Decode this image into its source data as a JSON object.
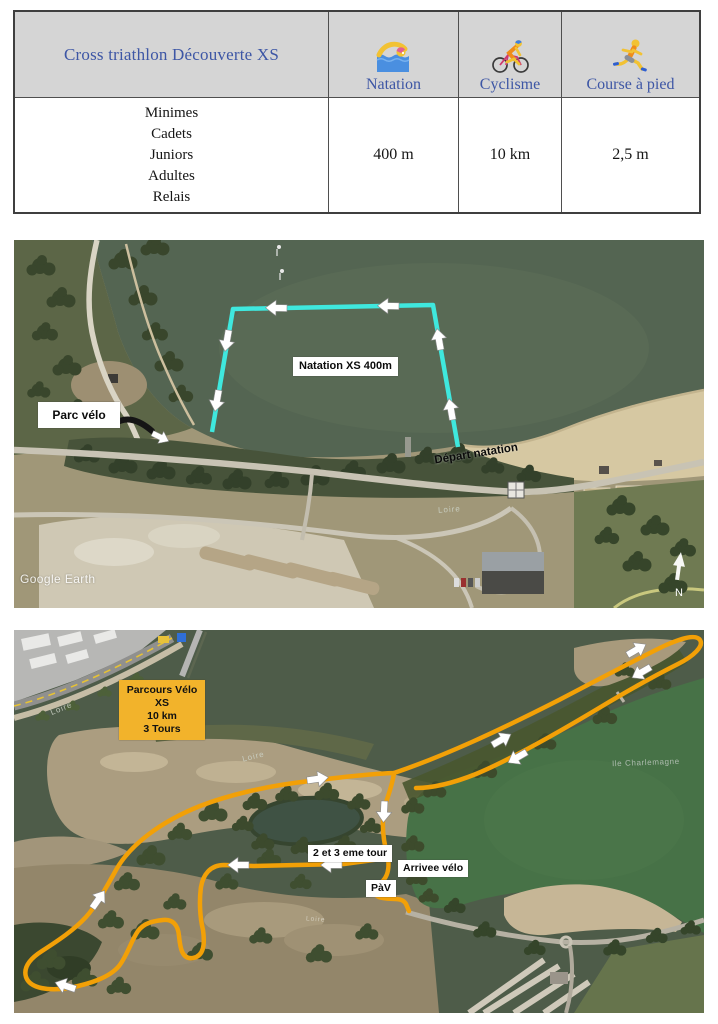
{
  "table": {
    "title": "Cross triathlon Découverte XS",
    "columns": [
      {
        "label": "Natation",
        "icon": "swimmer-icon"
      },
      {
        "label": "Cyclisme",
        "icon": "cyclist-icon"
      },
      {
        "label": "Course à pied",
        "icon": "runner-icon"
      }
    ],
    "categories": [
      "Minimes",
      "Cadets",
      "Juniors",
      "Adultes",
      "Relais"
    ],
    "distances": [
      "400 m",
      "10 km",
      "2,5 m"
    ],
    "header_bg": "#d5d5d5",
    "title_color": "#3d56a5"
  },
  "swim_map": {
    "course_label": "Natation XS 400m",
    "parc_velo_label": "Parc vélo",
    "depart_label": "Départ natation",
    "river_label": "Loire",
    "watermark": "Google Earth",
    "north_label": "N",
    "course_color": "#3fe8de"
  },
  "bike_map": {
    "info_line1": "Parcours Vélo XS",
    "info_line2": "10 km",
    "info_line3": "3 Tours",
    "info_box_style": "background:#f2b32b",
    "tour_label": "2 et 3 eme tour",
    "arrivee_label": "Arrivee vélo",
    "pav_label": "PàV",
    "river_labels": [
      "Loire",
      "Loire",
      "Loire"
    ],
    "island_label": "Ile Charlemagne",
    "course_color": "#f2a007"
  }
}
